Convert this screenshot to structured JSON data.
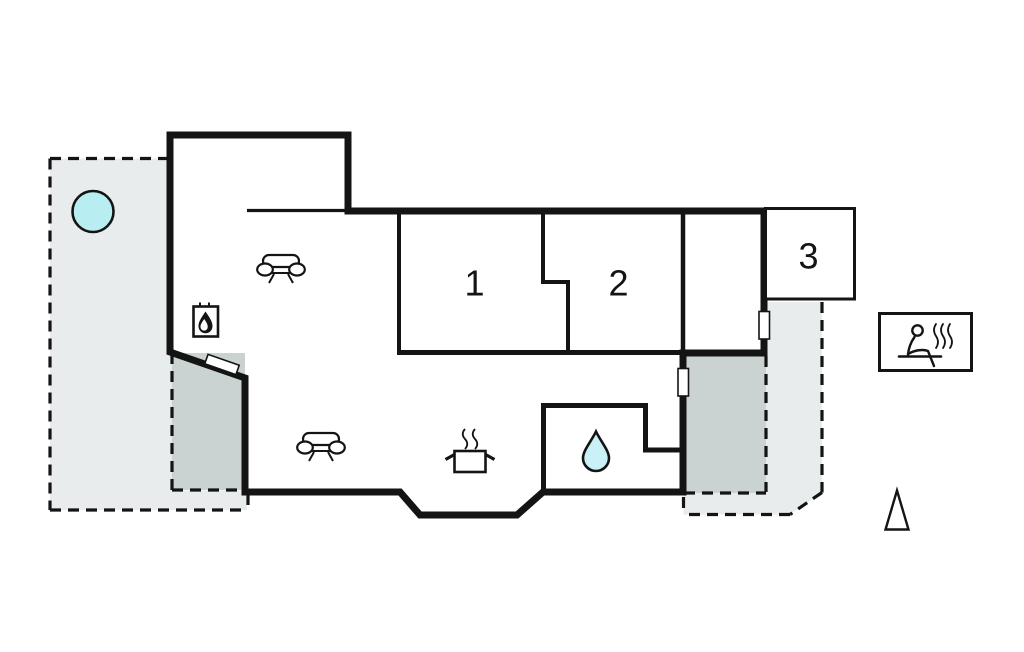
{
  "plan": {
    "rooms": [
      {
        "label": "1"
      },
      {
        "label": "2"
      },
      {
        "label": "3"
      }
    ],
    "colors": {
      "wall": "#141414",
      "terrace_light": "#e8ecec",
      "terrace_dark": "#cbd3d2",
      "hot_tub_water": "#b8eef2",
      "water_drop": "#c9f1f7",
      "background": "#ffffff"
    },
    "icons": {
      "hot_tub": "hot-tub-icon",
      "sofa": "sofa-icon",
      "wood_stove": "wood-stove-icon",
      "cooking_pot": "cooking-pot-icon",
      "water_drop": "water-drop-icon",
      "sauna": "sauna-icon",
      "north_arrow": "north-arrow-icon"
    }
  }
}
